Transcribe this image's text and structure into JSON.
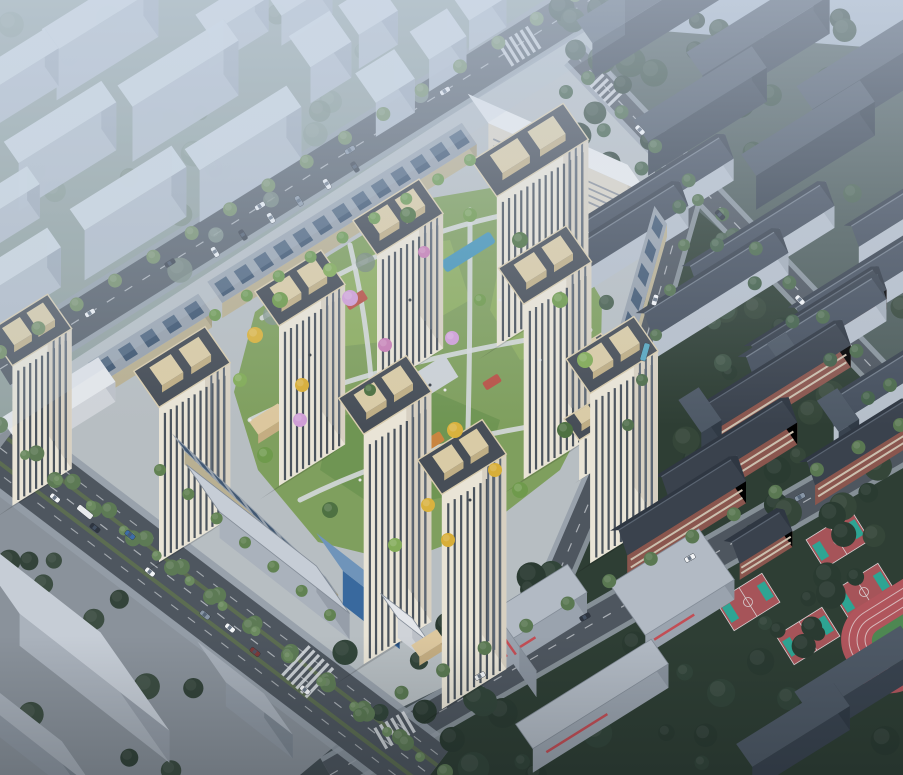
{
  "scene": {
    "label": "aerial-render-residential-masterplan",
    "width": 903,
    "height": 775,
    "description": "Bird's-eye architectural rendering: cream residential towers around a green courtyard, surrounded by roads, context massing, existing apartment rows, school campus with sports courts and track"
  },
  "axes": {
    "u": -32,
    "v": 55
  },
  "palette": {
    "bg_top": "#aab7c5",
    "bg_mid1": "#8d9aa3",
    "bg_mid2": "#6d7a7c",
    "bg_bot": "#434d53",
    "ctx_ground": "#8f9e99",
    "complex_ground": "#b7bec2",
    "school_ground": "#2e3e34",
    "apt_ground": "#4d5c5a",
    "sw_ground": "#8a929b",
    "asphalt": "#4e565f",
    "asphalt2": "#565e68",
    "sidewalk": "#949ea8",
    "lane": "#e8ebee",
    "median_green": "#5e7050",
    "lawn": "#7f9f5e",
    "lawn_light": "#8fae62",
    "lawn_dark": "#6e9452",
    "path": "#d5d8db",
    "pool": "#4795b8",
    "play_red": "#b85348",
    "play_orange": "#c98540",
    "court_base": "#a65459",
    "court_key": "#2ea493",
    "court_line": "#d8d0d2",
    "track_red": "#b0555c",
    "track_line": "#d7b9bb",
    "track_infield": "#4e8752",
    "tree_bright": "#6f8a5f",
    "tree_mid": "#5d7a55",
    "tree_dark": "#31443a",
    "tree_school": "#2a3b31",
    "haze": "#d2ddee"
  },
  "styles": {
    "context": {
      "top": "#cfd8e1",
      "front": "#b3bdc9",
      "side": "#9ca7b4",
      "op": 0.96
    },
    "darkslab": {
      "top": "#4e5966",
      "front": "#39434f",
      "side": "#303a45",
      "op": 1
    },
    "white": {
      "top": "#e9ebec",
      "front": "#d9d3c5",
      "side": "#c8c2b4",
      "line": "#8b9199",
      "a1": 24
    },
    "apt": {
      "wall": "#b6bfca",
      "wallS": "#a3adb8",
      "roofF": "#46505e",
      "roofB": "#38414d",
      "ridge": "#717c89"
    },
    "red": {
      "wall": "#8a564e",
      "band": "#cbbfae",
      "roofF": "#3a424d",
      "roofB": "#2f3742",
      "ridge": "#5a6471"
    },
    "tower": {
      "front": "#e9e4d6",
      "side": "#d7d0c1",
      "win": "#4a535d",
      "winS": "#5d6875",
      "roof": "#474e57",
      "roofline": "#3a4047",
      "crownTop": "#d9cba6",
      "crownSide": "#bfae85",
      "parapet": "#d8ccae"
    },
    "pv": {
      "top": "#97a1ac",
      "front": "#b9b092",
      "side": "#a59c80",
      "panel": "#3b536e"
    },
    "gate": {
      "top": "#dcc79e",
      "front": "#c4ad82",
      "side": "#b29a6f",
      "op": 1
    },
    "flat": {
      "top": "#b2bac4",
      "front": "#9aa3ae",
      "side": "#8a939e",
      "accent": "#c24e55",
      "op": 1
    },
    "flatlight": {
      "top": "#c6cdd6",
      "front": "#aab2bc",
      "side": "#969ea9",
      "op": 1
    },
    "glass": {
      "top": "#6f94ba",
      "front": "#39699e",
      "side": "#2c5587",
      "op": 1
    },
    "slabgray": {
      "top": "#a8b0ba",
      "front": "#8f98a3",
      "side": "#7d8792",
      "op": 1
    },
    "whitelow": {
      "top": "#e3e6ea",
      "front": "#cfd3d8",
      "side": "#bcc1c8",
      "op": 1
    }
  },
  "ground_regions": {
    "context": [
      [
        0,
        0
      ],
      [
        625,
        0
      ],
      [
        625,
        35
      ],
      [
        0,
        435
      ]
    ],
    "apartments": [
      [
        585,
        25
      ],
      [
        903,
        50
      ],
      [
        903,
        405
      ],
      [
        635,
        170
      ]
    ],
    "school": [
      [
        640,
        160
      ],
      [
        903,
        390
      ],
      [
        903,
        775
      ],
      [
        340,
        775
      ],
      [
        520,
        650
      ],
      [
        622,
        430
      ],
      [
        658,
        150
      ]
    ],
    "complex": [
      [
        12,
        400
      ],
      [
        585,
        28
      ],
      [
        658,
        150
      ],
      [
        620,
        432
      ],
      [
        530,
        645
      ],
      [
        345,
        735
      ],
      [
        38,
        432
      ]
    ],
    "southwest": [
      [
        0,
        430
      ],
      [
        40,
        430
      ],
      [
        348,
        735
      ],
      [
        300,
        775
      ],
      [
        0,
        775
      ]
    ]
  },
  "courtyard": {
    "blob": [
      [
        255,
        312
      ],
      [
        330,
        255
      ],
      [
        420,
        200
      ],
      [
        502,
        186
      ],
      [
        562,
        232
      ],
      [
        602,
        300
      ],
      [
        600,
        392
      ],
      [
        560,
        470
      ],
      [
        480,
        532
      ],
      [
        400,
        562
      ],
      [
        318,
        542
      ],
      [
        258,
        470
      ],
      [
        234,
        392
      ]
    ],
    "lawns": [
      [
        [
          300,
          300
        ],
        [
          380,
          250
        ],
        [
          450,
          240
        ],
        [
          470,
          300
        ],
        [
          400,
          340
        ],
        [
          310,
          350
        ]
      ],
      [
        [
          330,
          420
        ],
        [
          430,
          390
        ],
        [
          500,
          420
        ],
        [
          480,
          490
        ],
        [
          380,
          510
        ],
        [
          320,
          470
        ]
      ],
      [
        [
          500,
          260
        ],
        [
          560,
          280
        ],
        [
          575,
          350
        ],
        [
          520,
          360
        ],
        [
          490,
          310
        ]
      ]
    ],
    "paths": [
      "M262,318 C340,270 420,230 520,212",
      "M250,420 C330,380 450,350 590,330",
      "M300,500 C380,460 480,430 580,420",
      "M350,245 C370,330 380,430 370,540",
      "M470,210 C470,300 470,400 465,520"
    ],
    "pools": [
      [
        468,
        252,
        58,
        13
      ],
      [
        524,
        298,
        40,
        11
      ]
    ],
    "play": [
      [
        356,
        300,
        22,
        11,
        "#b85348"
      ],
      [
        432,
        442,
        24,
        11,
        "#c98540"
      ],
      [
        492,
        382,
        18,
        9,
        "#b85348"
      ]
    ],
    "decks": [
      [
        432,
        378,
        46,
        26
      ],
      [
        300,
        430,
        30,
        18
      ]
    ]
  },
  "roads": {
    "A": {
      "pts": [
        [
          0,
          369
        ],
        [
          590,
          0
        ]
      ],
      "w": 38
    },
    "B": {
      "pts": [
        [
          0,
          448
        ],
        [
          430,
          775
        ]
      ],
      "w": 64,
      "side": 14
    },
    "C": {
      "pts": [
        [
          330,
          775
        ],
        [
          903,
          445
        ]
      ],
      "w": 30
    },
    "D": {
      "pts": [
        [
          690,
          185
        ],
        [
          620,
          430
        ],
        [
          530,
          640
        ]
      ],
      "w": 22
    },
    "F": {
      "pts": [
        [
          575,
          55
        ],
        [
          903,
          400
        ]
      ],
      "w": 20
    }
  },
  "crosswalks": [
    [
      395,
      730,
      -30,
      24
    ],
    [
      308,
      672,
      43,
      40
    ],
    [
      520,
      46,
      -32,
      26
    ],
    [
      538,
      622,
      -30,
      20
    ],
    [
      604,
      88,
      46,
      18
    ]
  ],
  "context_boxes": [
    [
      100,
      58,
      120,
      26,
      50
    ],
    [
      22,
      95,
      70,
      24,
      38
    ],
    [
      178,
      118,
      125,
      26,
      55
    ],
    [
      60,
      170,
      115,
      26,
      48
    ],
    [
      243,
      180,
      120,
      26,
      52
    ],
    [
      128,
      238,
      120,
      26,
      50
    ],
    [
      18,
      300,
      85,
      24,
      40
    ],
    [
      8,
      225,
      60,
      22,
      34
    ],
    [
      232,
      40,
      70,
      24,
      34
    ],
    [
      300,
      20,
      60,
      24,
      30
    ],
    [
      320,
      75,
      48,
      38,
      36
    ],
    [
      368,
      42,
      46,
      36,
      34
    ],
    [
      385,
      110,
      46,
      36,
      34
    ],
    [
      438,
      66,
      44,
      34,
      32
    ],
    [
      478,
      25,
      44,
      34,
      30
    ]
  ],
  "dark_slabs": [
    [
      648,
      28,
      150,
      28,
      36
    ],
    [
      758,
      62,
      150,
      28,
      38
    ],
    [
      868,
      96,
      150,
      28,
      38
    ],
    [
      700,
      128,
      140,
      26,
      34
    ],
    [
      808,
      162,
      140,
      26,
      34
    ]
  ],
  "white_slab": [
    558,
    190,
    175,
    36,
    46
  ],
  "apartments": [
    [
      655,
      212,
      165,
      30,
      22,
      12
    ],
    [
      612,
      258,
      160,
      30,
      22,
      12
    ],
    [
      758,
      258,
      160,
      30,
      22,
      12
    ],
    [
      712,
      305,
      160,
      30,
      22,
      12
    ],
    [
      860,
      302,
      150,
      30,
      22,
      12
    ],
    [
      812,
      350,
      155,
      30,
      22,
      12
    ],
    [
      885,
      398,
      140,
      28,
      20,
      11
    ],
    [
      898,
      225,
      110,
      26,
      18,
      10
    ]
  ],
  "school_red": [
    [
      770,
      400,
      170,
      30,
      22,
      13
    ],
    [
      725,
      472,
      150,
      30,
      22,
      13
    ],
    [
      815,
      338,
      150,
      28,
      20,
      12
    ],
    [
      858,
      462,
      120,
      28,
      20,
      12
    ],
    [
      678,
      528,
      140,
      30,
      22,
      13
    ],
    [
      758,
      552,
      62,
      28,
      16,
      10
    ]
  ],
  "school_stubs": [
    [
      700,
      432,
      24,
      40,
      22
    ],
    [
      838,
      432,
      24,
      38,
      22
    ],
    [
      786,
      372,
      22,
      34,
      20
    ]
  ],
  "strips_pv": [
    [
      342,
      228,
      300,
      26,
      15
    ],
    [
      150,
      352,
      130,
      24,
      14
    ],
    [
      255,
      527,
      210,
      22,
      13,
      43
    ],
    [
      640,
      300,
      150,
      22,
      13,
      106
    ]
  ],
  "gates": [
    [
      268,
      428,
      34,
      16,
      9
    ],
    [
      612,
      400,
      30,
      14,
      9
    ],
    [
      428,
      652,
      30,
      14,
      9
    ]
  ],
  "midrises": [
    [
      583,
      400,
      60,
      26,
      40
    ],
    [
      595,
      455,
      55,
      26,
      40
    ]
  ],
  "towers": [
    [
      530,
      300,
      108,
      44,
      150
    ],
    [
      398,
      352,
      78,
      42,
      135
    ],
    [
      300,
      448,
      78,
      42,
      160
    ],
    [
      182,
      522,
      84,
      44,
      155
    ],
    [
      545,
      440,
      80,
      44,
      175
    ],
    [
      612,
      525,
      80,
      42,
      170
    ],
    [
      385,
      625,
      80,
      44,
      230
    ],
    [
      462,
      672,
      76,
      42,
      215
    ],
    [
      30,
      470,
      70,
      42,
      140
    ]
  ],
  "flat_school": [
    [
      520,
      640,
      135,
      34,
      26
    ],
    [
      505,
      652,
      80,
      30,
      26,
      55
    ],
    [
      592,
      718,
      160,
      30,
      24
    ],
    [
      672,
      602,
      105,
      62,
      20
    ]
  ],
  "dark_bottom": [
    [
      856,
      697,
      125,
      30,
      26
    ],
    [
      793,
      749,
      115,
      28,
      24
    ]
  ],
  "commercial": [
    [
      268,
      565,
      165,
      58,
      26,
      "flatlight",
      38
    ],
    [
      358,
      608,
      72,
      46,
      34,
      "glass",
      38
    ],
    [
      405,
      638,
      40,
      30,
      20,
      "whitelow",
      38
    ]
  ],
  "sw_blocks": [
    [
      60,
      655,
      190,
      120,
      32,
      "flatlight",
      38
    ],
    [
      28,
      748,
      130,
      60,
      22,
      "slabgray",
      38
    ],
    [
      245,
      712,
      85,
      50,
      24,
      "slabgray",
      38
    ],
    [
      58,
      420,
      115,
      30,
      20,
      "whitelow"
    ]
  ],
  "courts": [
    [
      688,
      568
    ],
    [
      748,
      602
    ],
    [
      808,
      636
    ],
    [
      864,
      592
    ],
    [
      838,
      540
    ]
  ],
  "track": {
    "cx": 915,
    "cy": 628,
    "rx": 75,
    "ry": 48
  },
  "tree_clusters": [
    {
      "x": 0,
      "y": 0,
      "w": 430,
      "h": 320,
      "n": 26,
      "r1": 7,
      "r2": 14,
      "cols": [
        "#75877b",
        "#81948a"
      ],
      "op": 0.8,
      "seed": 11
    },
    {
      "x": 560,
      "y": 0,
      "w": 343,
      "h": 170,
      "n": 30,
      "r1": 8,
      "r2": 16,
      "cols": [
        "#31443a",
        "#3a4f42"
      ],
      "op": 1,
      "seed": 22
    },
    {
      "x": 620,
      "y": 290,
      "w": 283,
      "h": 290,
      "n": 32,
      "r1": 7,
      "r2": 15,
      "cols": [
        "#2a3b31",
        "#354639"
      ],
      "op": 1,
      "seed": 33
    },
    {
      "x": 340,
      "y": 565,
      "w": 560,
      "h": 210,
      "n": 40,
      "r1": 7,
      "r2": 16,
      "cols": [
        "#2a3a31",
        "#32453a"
      ],
      "op": 1,
      "seed": 44
    },
    {
      "x": 580,
      "y": 175,
      "w": 320,
      "h": 215,
      "n": 16,
      "r1": 6,
      "r2": 10,
      "cols": [
        "#3e5345",
        "#4a6150"
      ],
      "op": 1,
      "seed": 55
    },
    {
      "x": 0,
      "y": 560,
      "w": 200,
      "h": 215,
      "n": 12,
      "r1": 8,
      "r2": 14,
      "cols": [
        "#33433a",
        "#3c4d42"
      ],
      "op": 1,
      "seed": 66
    }
  ],
  "tree_rows": [
    {
      "p1": [
        0,
        352
      ],
      "p2": [
        575,
        -5
      ],
      "n": 16,
      "r": 7,
      "c": "#6f8a5f"
    },
    {
      "p1": [
        0,
        425
      ],
      "p2": [
        400,
        737
      ],
      "n": 12,
      "r": 8,
      "c": "#5d7a55"
    },
    {
      "p1": [
        55,
        480
      ],
      "p2": [
        445,
        772
      ],
      "n": 11,
      "r": 8,
      "c": "#5d7a55"
    },
    {
      "p1": [
        25,
        455
      ],
      "p2": [
        420,
        757
      ],
      "n": 13,
      "r": 5,
      "c": "#6b8a5f"
    },
    {
      "p1": [
        360,
        715
      ],
      "p2": [
        900,
        425
      ],
      "n": 14,
      "r": 7,
      "c": "#5a7852"
    },
    {
      "p1": [
        698,
        200
      ],
      "p2": [
        628,
        425
      ],
      "n": 6,
      "r": 6,
      "c": "#52704e"
    },
    {
      "p1": [
        588,
        78
      ],
      "p2": [
        890,
        385
      ],
      "n": 10,
      "r": 7,
      "c": "#4c6a4c"
    },
    {
      "p1": [
        566,
        92
      ],
      "p2": [
        868,
        398
      ],
      "n": 9,
      "r": 7,
      "c": "#44614a"
    },
    {
      "p1": [
        215,
        315
      ],
      "p2": [
        470,
        160
      ],
      "n": 9,
      "r": 6,
      "c": "#6f9a55"
    },
    {
      "p1": [
        160,
        470
      ],
      "p2": [
        330,
        615
      ],
      "n": 7,
      "r": 6,
      "c": "#618252"
    }
  ],
  "courtyard_trees": [
    [
      350,
      298,
      8,
      "#cf9ed6"
    ],
    [
      385,
      345,
      7,
      "#c77fb5"
    ],
    [
      452,
      338,
      7,
      "#d0a0d8"
    ],
    [
      300,
      420,
      7,
      "#cf9ed6"
    ],
    [
      424,
      252,
      6,
      "#c77fb5"
    ],
    [
      255,
      335,
      8,
      "#d9b23e"
    ],
    [
      302,
      385,
      7,
      "#d8ae38"
    ],
    [
      455,
      430,
      8,
      "#d9b23e"
    ],
    [
      495,
      470,
      7,
      "#d8ae38"
    ],
    [
      428,
      505,
      7,
      "#d9b23e"
    ],
    [
      448,
      540,
      7,
      "#d8ae38"
    ],
    [
      280,
      300,
      8,
      "#6f9a4c"
    ],
    [
      330,
      270,
      7,
      "#82ab58"
    ],
    [
      408,
      215,
      8,
      "#4e7142"
    ],
    [
      470,
      215,
      7,
      "#6f9a4c"
    ],
    [
      520,
      240,
      8,
      "#4e7142"
    ],
    [
      560,
      300,
      8,
      "#6f9a4c"
    ],
    [
      585,
      360,
      8,
      "#82ab58"
    ],
    [
      565,
      430,
      8,
      "#4e7142"
    ],
    [
      520,
      490,
      8,
      "#6f9a4c"
    ],
    [
      395,
      545,
      7,
      "#82ab58"
    ],
    [
      330,
      510,
      8,
      "#4e7142"
    ],
    [
      265,
      455,
      8,
      "#6f9a4c"
    ],
    [
      240,
      380,
      7,
      "#82ab58"
    ],
    [
      480,
      300,
      6,
      "#6f9a4c"
    ],
    [
      370,
      390,
      6,
      "#4e7142"
    ]
  ],
  "cars": [
    [
      90,
      313,
      -32,
      "#f2f4f6"
    ],
    [
      170,
      263,
      -32,
      "#2e3540"
    ],
    [
      260,
      206,
      -32,
      "#f2f4f6"
    ],
    [
      350,
      150,
      -32,
      "#8795a5"
    ],
    [
      445,
      91,
      -32,
      "#f2f4f6"
    ],
    [
      55,
      498,
      39,
      "#f2f4f6"
    ],
    [
      95,
      528,
      39,
      "#2e3540"
    ],
    [
      150,
      572,
      39,
      "#f2f4f6"
    ],
    [
      205,
      615,
      39,
      "#8795a5"
    ],
    [
      255,
      652,
      39,
      "#7d3a3a"
    ],
    [
      305,
      690,
      39,
      "#f2f4f6"
    ],
    [
      130,
      535,
      39,
      "#3d6da8"
    ],
    [
      230,
      628,
      39,
      "#f2f4f6"
    ],
    [
      480,
      676,
      -29,
      "#f2f4f6"
    ],
    [
      585,
      617,
      -29,
      "#2e3540"
    ],
    [
      690,
      558,
      -29,
      "#f2f4f6"
    ],
    [
      800,
      497,
      -29,
      "#8795a5"
    ],
    [
      655,
      300,
      106,
      "#f2f4f6"
    ],
    [
      640,
      130,
      46,
      "#f2f4f6"
    ],
    [
      720,
      215,
      46,
      "#2e3540"
    ],
    [
      800,
      300,
      46,
      "#f2f4f6"
    ],
    [
      215,
      252,
      58,
      "#f2f4f6"
    ],
    [
      243,
      235,
      58,
      "#2e3540"
    ],
    [
      271,
      218,
      58,
      "#f2f4f6"
    ],
    [
      299,
      201,
      58,
      "#8795a5"
    ],
    [
      327,
      184,
      58,
      "#f2f4f6"
    ],
    [
      355,
      167,
      58,
      "#2e3540"
    ]
  ],
  "buses": [
    [
      645,
      352,
      106,
      "#5aa8c0"
    ],
    [
      85,
      512,
      39,
      "#e8eaec"
    ]
  ],
  "people": [
    [
      430,
      385
    ],
    [
      445,
      390
    ],
    [
      300,
      360
    ],
    [
      310,
      355
    ],
    [
      500,
      300
    ],
    [
      360,
      480
    ],
    [
      470,
      500
    ],
    [
      250,
      420
    ],
    [
      540,
      360
    ],
    [
      410,
      300
    ]
  ]
}
